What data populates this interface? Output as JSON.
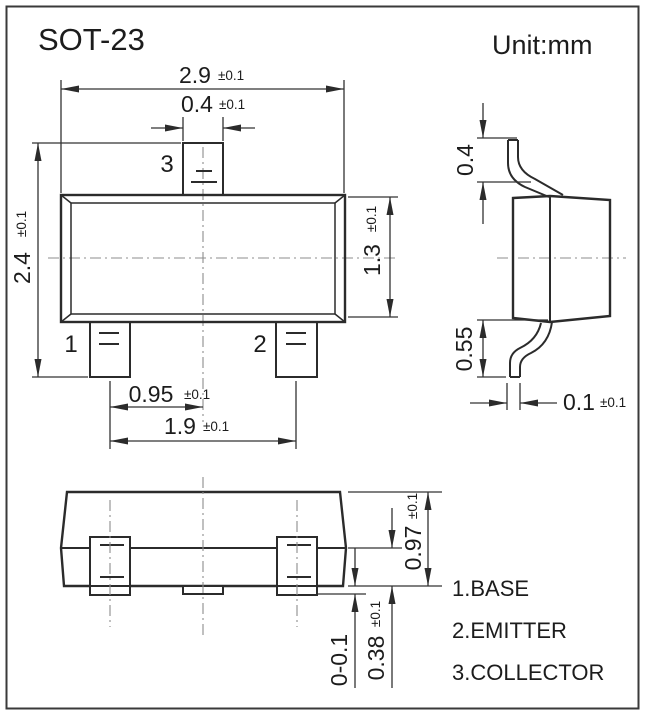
{
  "title": "SOT-23",
  "unit_label": "Unit:mm",
  "front_view": {
    "pin_labels": {
      "pin1": "1",
      "pin2": "2",
      "pin3": "3"
    },
    "dims": {
      "body_width": {
        "value": "2.9",
        "tol": "±0.1"
      },
      "pin3_width": {
        "value": "0.4",
        "tol": "±0.1"
      },
      "overall_height": {
        "value": "2.4",
        "tol": "±0.1"
      },
      "body_height": {
        "value": "1.3",
        "tol": "±0.1"
      },
      "pin_pitch": {
        "value": "0.95",
        "tol": "±0.1"
      },
      "pin_span": {
        "value": "1.9",
        "tol": "±0.1"
      }
    }
  },
  "side_view": {
    "dims": {
      "lead_top_height": {
        "value": "0.4"
      },
      "lead_bottom_height": {
        "value": "0.55"
      },
      "lead_thickness": {
        "value": "0.1",
        "tol": "±0.1"
      }
    }
  },
  "bottom_view": {
    "dims": {
      "body_thickness": {
        "value": "0.97",
        "tol": "±0.1"
      },
      "lead_profile_height": {
        "value": "0.38",
        "tol": "±0.1"
      },
      "standoff": {
        "value": "0-0.1"
      }
    }
  },
  "legend": {
    "items": [
      {
        "text": "1.BASE"
      },
      {
        "text": "2.EMITTER"
      },
      {
        "text": "3.COLLECTOR"
      }
    ]
  },
  "colors": {
    "line": "#2b2b2b",
    "centerline": "#8c8c8c",
    "text": "#1c1c1c",
    "background": "#ffffff"
  }
}
